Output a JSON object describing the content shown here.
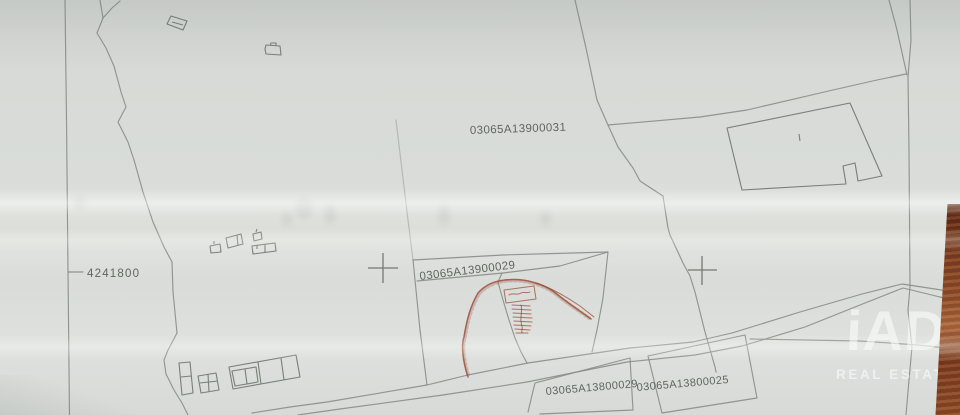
{
  "map": {
    "labels": {
      "parcel_top": "03065A13900031",
      "parcel_center": "03065A13900029",
      "parcel_bottom_left": "03065A13800029",
      "parcel_bottom_right": "03065A13800025",
      "grid_northing": "4241800"
    },
    "watermark": {
      "brand": "iAD",
      "tagline": "REAL ESTATE"
    },
    "colors": {
      "paper": "#d9dcd8",
      "line": "#878d87",
      "building": "#6e746e",
      "red": "#9c4b38",
      "maptext": "#4e554e",
      "wood": "#7d3c1f",
      "wm": "rgba(255,255,255,0.55)"
    }
  }
}
